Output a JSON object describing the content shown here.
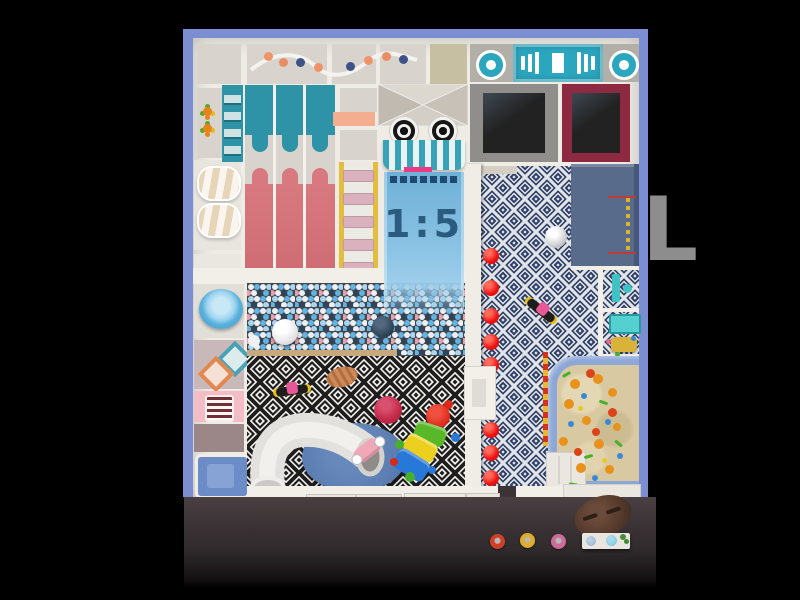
{
  "scene": {
    "description": "indoor playground floor plan render, top view",
    "scale_label": "1:5",
    "watermark_text": "L"
  },
  "palette": {
    "frame_blue": "#7b8ed1",
    "wall_white": "#efece5",
    "floor_gray": "#d8d4cd",
    "teal": "#2f93a8",
    "stage_teal": "#2ba6bf",
    "slide_pink": "#d8797f",
    "awning_teal": "#37a2b8",
    "hot_pink": "#ea3a84",
    "slide_blue": "#7ab4da",
    "ballpit_base": "#43474e",
    "navy_floor": "#2c3c62",
    "red_dot": "#ee1111",
    "slate_panel": "#596b8b",
    "trampoline_gray": "#908e8a",
    "trampoline_maroon": "#8d2a42",
    "trampoline_mat": "#222222",
    "sand": "#d8c9a2",
    "sand_border": "#8da7d7",
    "rug_blue": "#5b7cb0",
    "ottoman_crimson": "#c22848",
    "table_brown": "#54392b"
  },
  "track_dots": [
    {
      "x": 268,
      "y": 56,
      "s": 9,
      "c": "#ef9468"
    },
    {
      "x": 283,
      "y": 62,
      "s": 9,
      "c": "#e98e64"
    },
    {
      "x": 300,
      "y": 62,
      "s": 9,
      "c": "#3e5288"
    },
    {
      "x": 318,
      "y": 67,
      "s": 9,
      "c": "#ef9468"
    },
    {
      "x": 350,
      "y": 66,
      "s": 9,
      "c": "#3e5288"
    },
    {
      "x": 368,
      "y": 60,
      "s": 9,
      "c": "#ef9468"
    },
    {
      "x": 386,
      "y": 56,
      "s": 9,
      "c": "#e98e64"
    },
    {
      "x": 403,
      "y": 59,
      "s": 9,
      "c": "#3e5288"
    }
  ],
  "red_dots": {
    "x": 491,
    "size": 16,
    "ys": [
      256,
      288,
      316,
      342,
      365,
      430,
      453,
      478
    ]
  },
  "sand_toys": [
    {
      "x": 575,
      "y": 384,
      "s": 10,
      "c": "#e8921c"
    },
    {
      "x": 598,
      "y": 379,
      "s": 10,
      "c": "#e8921c"
    },
    {
      "x": 569,
      "y": 404,
      "s": 10,
      "c": "#e8921c"
    },
    {
      "x": 586,
      "y": 420,
      "s": 9,
      "c": "#e8921c"
    },
    {
      "x": 563,
      "y": 441,
      "s": 9,
      "c": "#e8921c"
    },
    {
      "x": 599,
      "y": 444,
      "s": 10,
      "c": "#e8921c"
    },
    {
      "x": 581,
      "y": 468,
      "s": 10,
      "c": "#e8921c"
    },
    {
      "x": 609,
      "y": 469,
      "s": 9,
      "c": "#e8921c"
    },
    {
      "x": 612,
      "y": 392,
      "s": 9,
      "c": "#e8921c"
    },
    {
      "x": 617,
      "y": 427,
      "s": 8,
      "c": "#e8921c"
    },
    {
      "x": 590,
      "y": 373,
      "s": 9,
      "c": "#dd4318"
    },
    {
      "x": 612,
      "y": 412,
      "s": 9,
      "c": "#dd4318"
    },
    {
      "x": 578,
      "y": 452,
      "s": 8,
      "c": "#dd4318"
    },
    {
      "x": 596,
      "y": 432,
      "s": 8,
      "c": "#dd4318"
    },
    {
      "x": 566,
      "y": 374,
      "s": 9,
      "h": 3,
      "c": "#48b028",
      "rot": -30,
      "shape": "stick"
    },
    {
      "x": 603,
      "y": 402,
      "s": 9,
      "h": 3,
      "c": "#48b028",
      "rot": 20,
      "shape": "stick"
    },
    {
      "x": 588,
      "y": 456,
      "s": 9,
      "h": 3,
      "c": "#48b028",
      "rot": -15,
      "shape": "stick"
    },
    {
      "x": 573,
      "y": 484,
      "s": 9,
      "h": 3,
      "c": "#48b028",
      "rot": 10,
      "shape": "stick"
    },
    {
      "x": 618,
      "y": 443,
      "s": 9,
      "h": 3,
      "c": "#48b028",
      "rot": 40,
      "shape": "stick"
    },
    {
      "x": 584,
      "y": 396,
      "s": 6,
      "c": "#3888d8"
    },
    {
      "x": 608,
      "y": 422,
      "s": 6,
      "c": "#3888d8"
    },
    {
      "x": 595,
      "y": 478,
      "s": 6,
      "c": "#3888d8"
    },
    {
      "x": 571,
      "y": 424,
      "s": 6,
      "c": "#3888d8"
    },
    {
      "x": 620,
      "y": 456,
      "s": 6,
      "c": "#3888d8"
    },
    {
      "x": 580,
      "y": 408,
      "s": 5,
      "c": "#e8c828"
    },
    {
      "x": 604,
      "y": 460,
      "s": 5,
      "c": "#e8c828"
    }
  ],
  "stools": [
    {
      "x": 497,
      "y": 541,
      "c": "#d04028"
    },
    {
      "x": 527,
      "y": 540,
      "c": "#e0ac2c"
    },
    {
      "x": 558,
      "y": 541,
      "c": "#cc6a9a"
    }
  ],
  "caterpillar_feet": [
    {
      "x": 448,
      "y": 404,
      "s": 9,
      "c": "#dd2818"
    },
    {
      "x": 455,
      "y": 437,
      "s": 9,
      "c": "#2878d8"
    },
    {
      "x": 399,
      "y": 444,
      "s": 9,
      "c": "#48b028"
    },
    {
      "x": 410,
      "y": 477,
      "s": 10,
      "c": "#48b028"
    },
    {
      "x": 394,
      "y": 462,
      "s": 8,
      "c": "#dd2818"
    },
    {
      "x": 432,
      "y": 470,
      "s": 8,
      "c": "#2878d8"
    }
  ],
  "equipment_labels": {
    "stage": "perspective stage panel",
    "targets": "round targets",
    "trampolines": [
      "gray trampoline",
      "maroon trampoline"
    ],
    "slides": [
      "triple wave slide",
      "toddler slide 1:5",
      "tube slide"
    ],
    "zones": [
      "ball pit",
      "diamond pattern floor",
      "navy key pattern floor",
      "sand pit",
      "reception"
    ]
  }
}
